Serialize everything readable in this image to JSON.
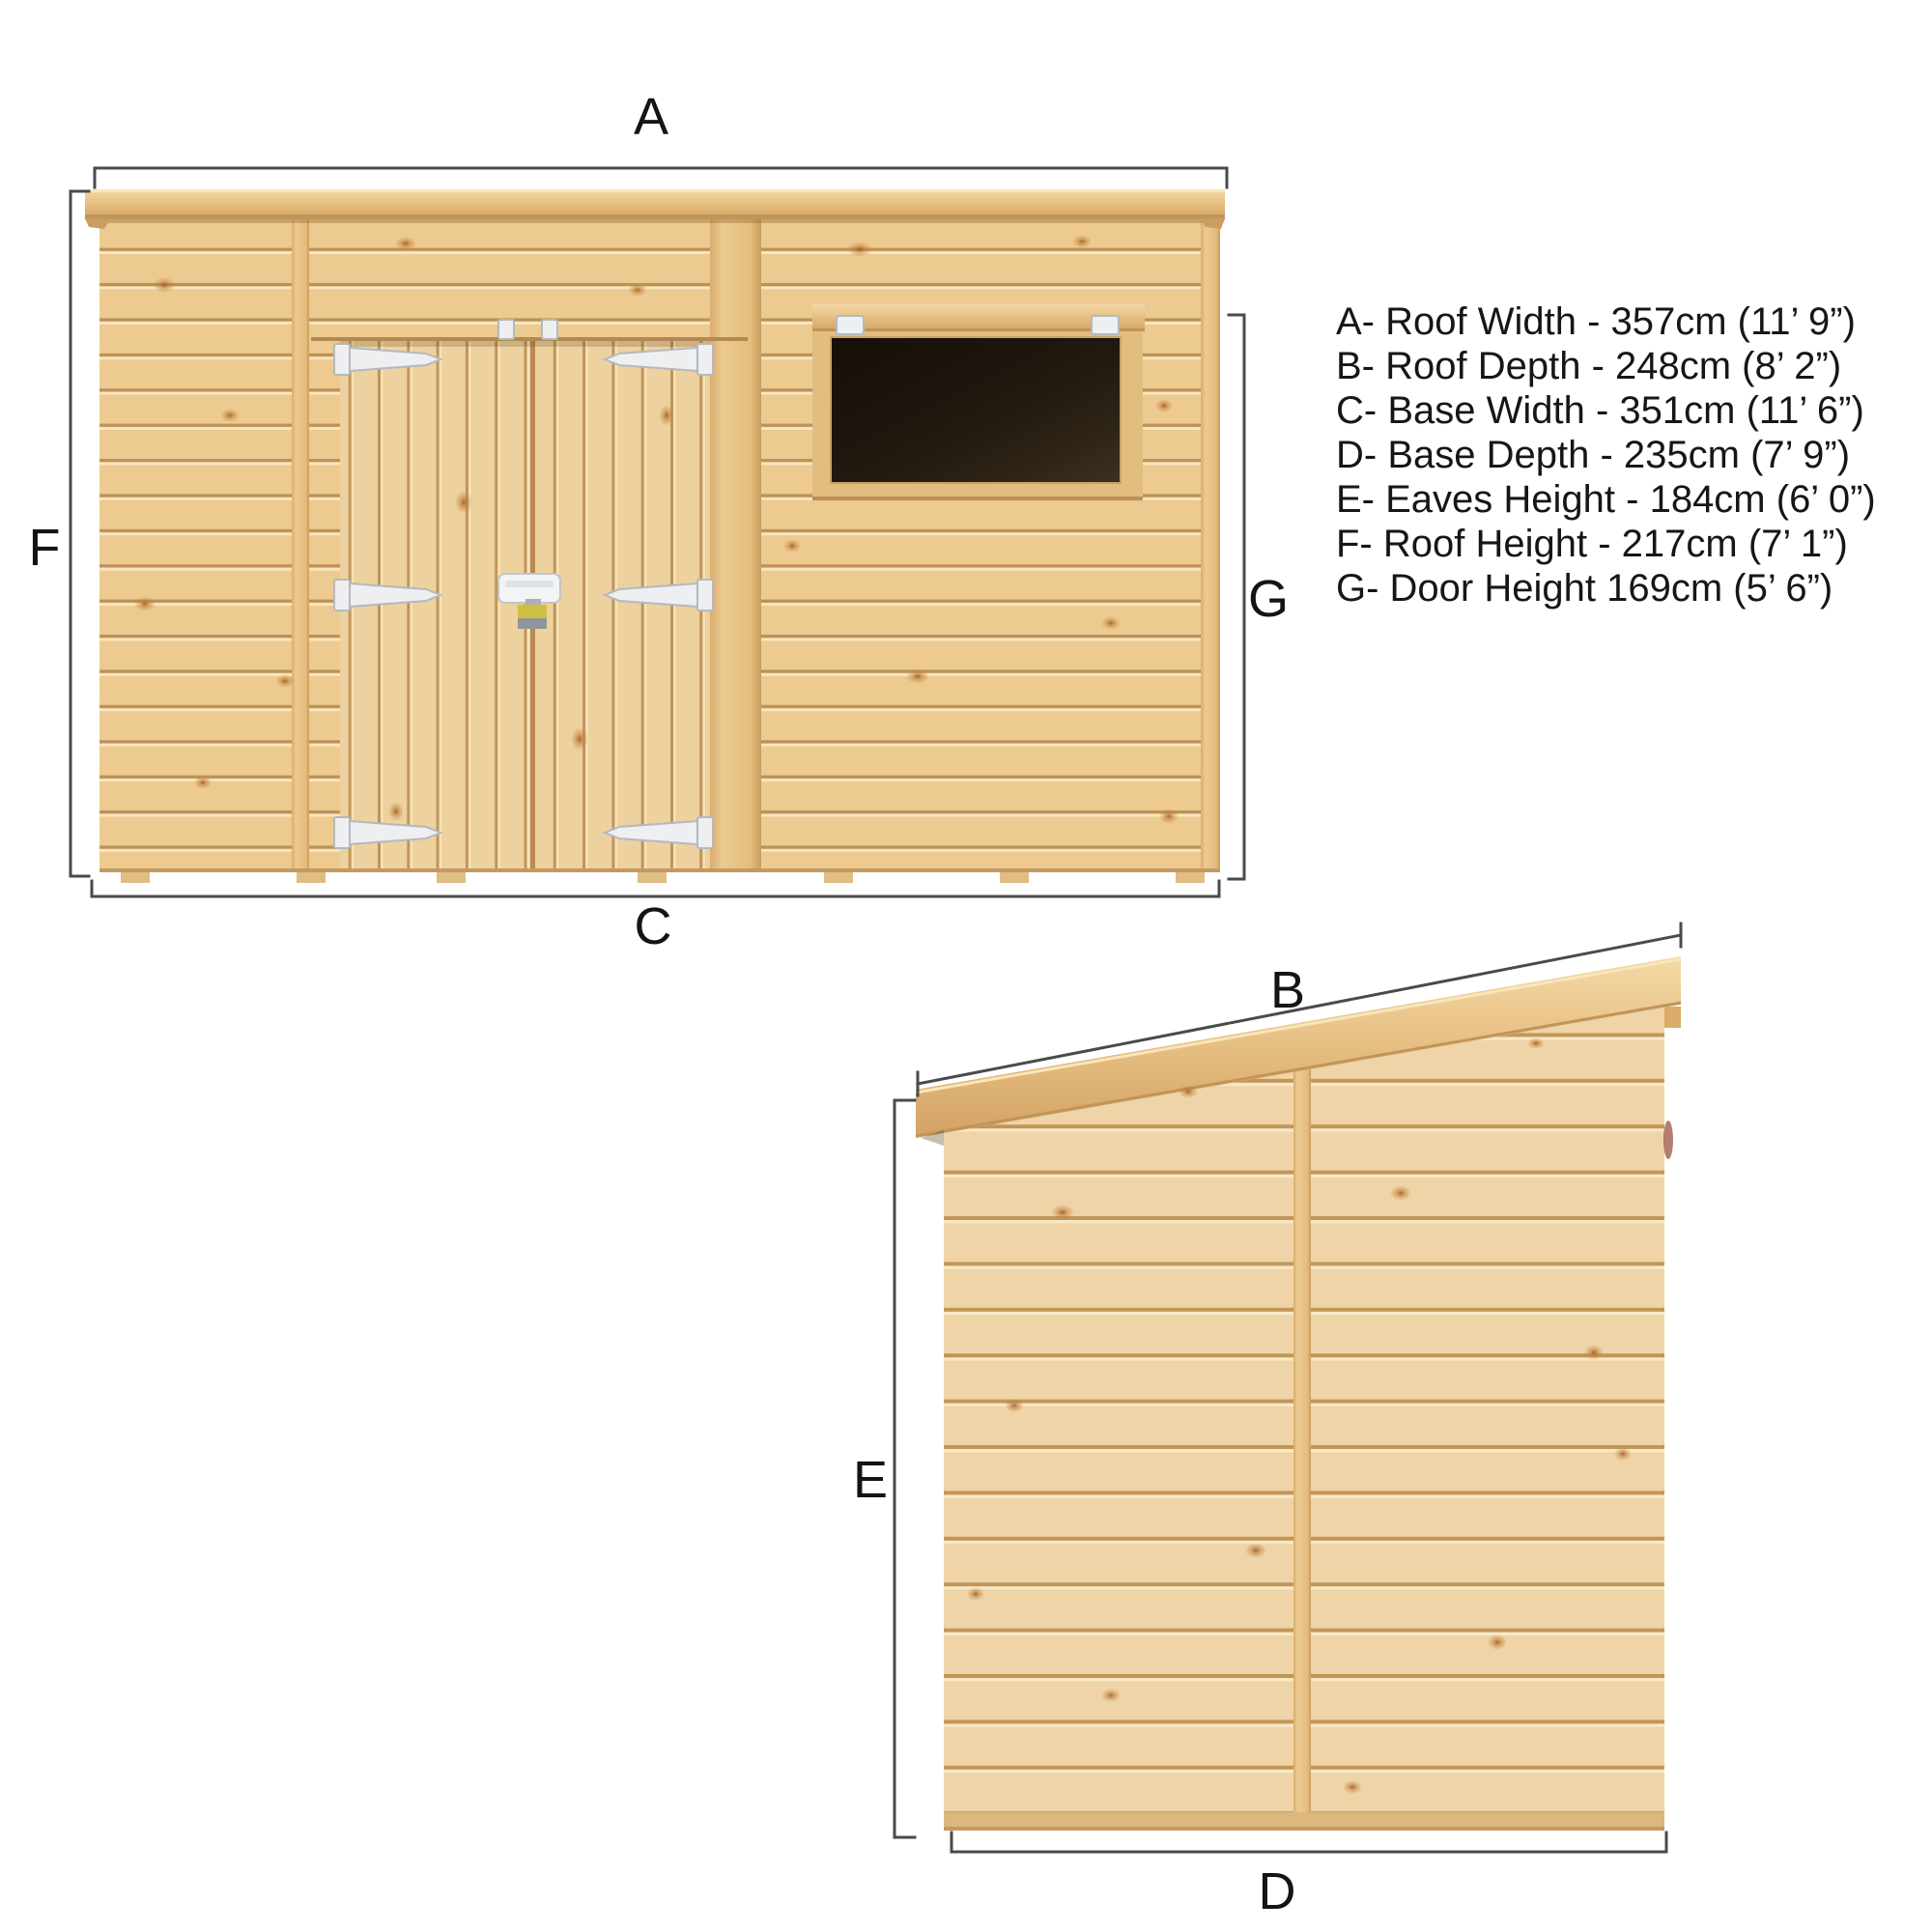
{
  "labels": {
    "a": "A",
    "b": "B",
    "c": "C",
    "d": "D",
    "e": "E",
    "f": "F",
    "g": "G"
  },
  "legend": {
    "items": [
      "A- Roof Width - 357cm (11’ 9”)",
      "B- Roof Depth - 248cm (8’ 2”)",
      "C- Base Width - 351cm (11’ 6”)",
      "D- Base Depth - 235cm (7’ 9”)",
      "E- Eaves Height - 184cm (6’ 0”)",
      "F- Roof Height - 217cm (7’ 1”)",
      "G- Door Height 169cm (5’ 6”)"
    ]
  },
  "dimensions": {
    "roof_width_cm": 357,
    "roof_depth_cm": 248,
    "base_width_cm": 351,
    "base_depth_cm": 235,
    "eaves_height_cm": 184,
    "roof_height_cm": 217,
    "door_height_cm": 169
  },
  "colors": {
    "wood_base": "#ecca90",
    "wood_gap_line": "#bd9257",
    "wood_highlight": "#f7e7c1",
    "door_wood": "#edd19e",
    "fascia_light": "#f4d9a6",
    "fascia_dark": "#d2a263",
    "glass_dark": "#150f08",
    "hardware_fill": "#edeff1",
    "hardware_stroke": "#b4b9bf",
    "padlock_yellow": "#cfc043",
    "padlock_grey": "#8f969c",
    "dimension_line": "#4a4a4a",
    "text": "#141414",
    "background": "#ffffff"
  }
}
